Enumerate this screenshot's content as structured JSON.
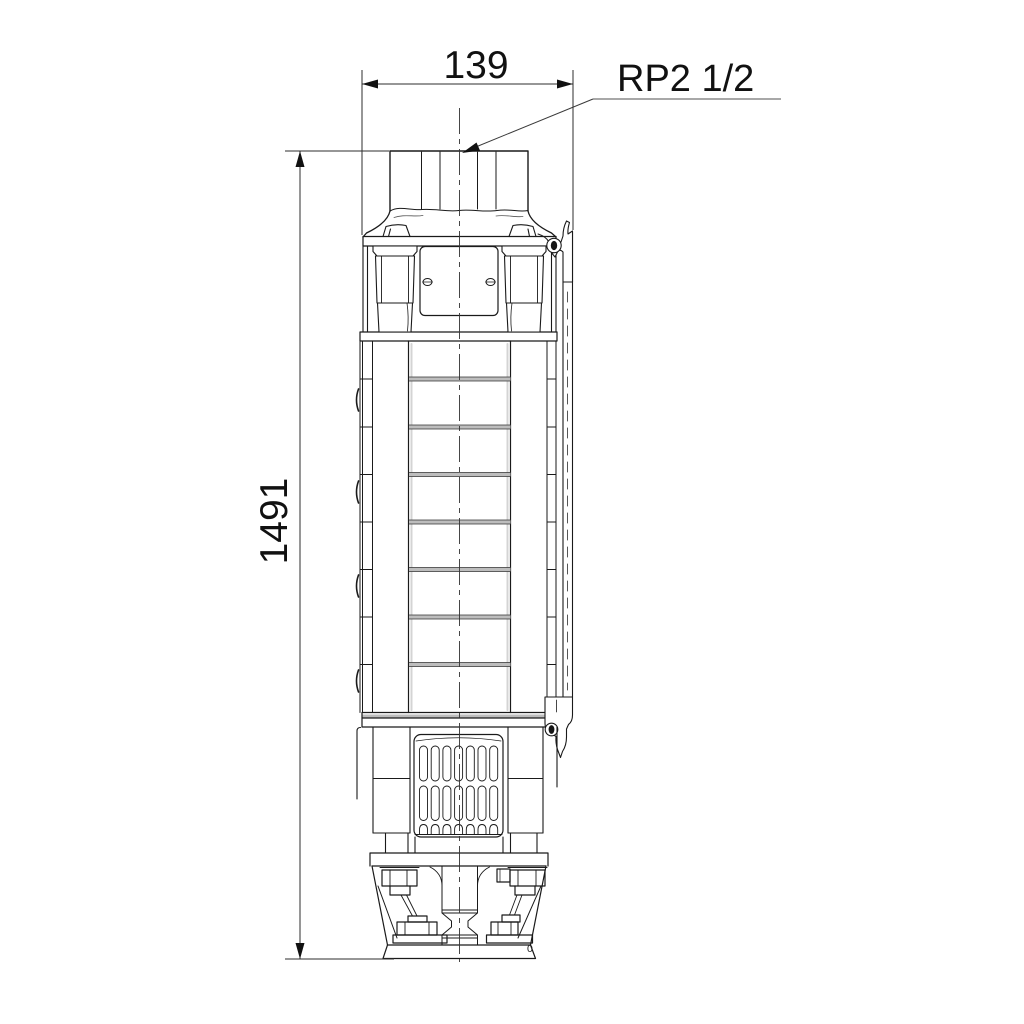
{
  "drawing": {
    "annotations": {
      "width_dimension": "139",
      "height_dimension": "1491",
      "connection_label": "RP2 1/2",
      "base_mark": "0"
    },
    "colors": {
      "background": "#ffffff",
      "line": "#1a1a1a",
      "dimension_line": "#2e2e2e",
      "leader_line": "#a8a8a8",
      "joint_fill": "#bdbdbd"
    }
  }
}
